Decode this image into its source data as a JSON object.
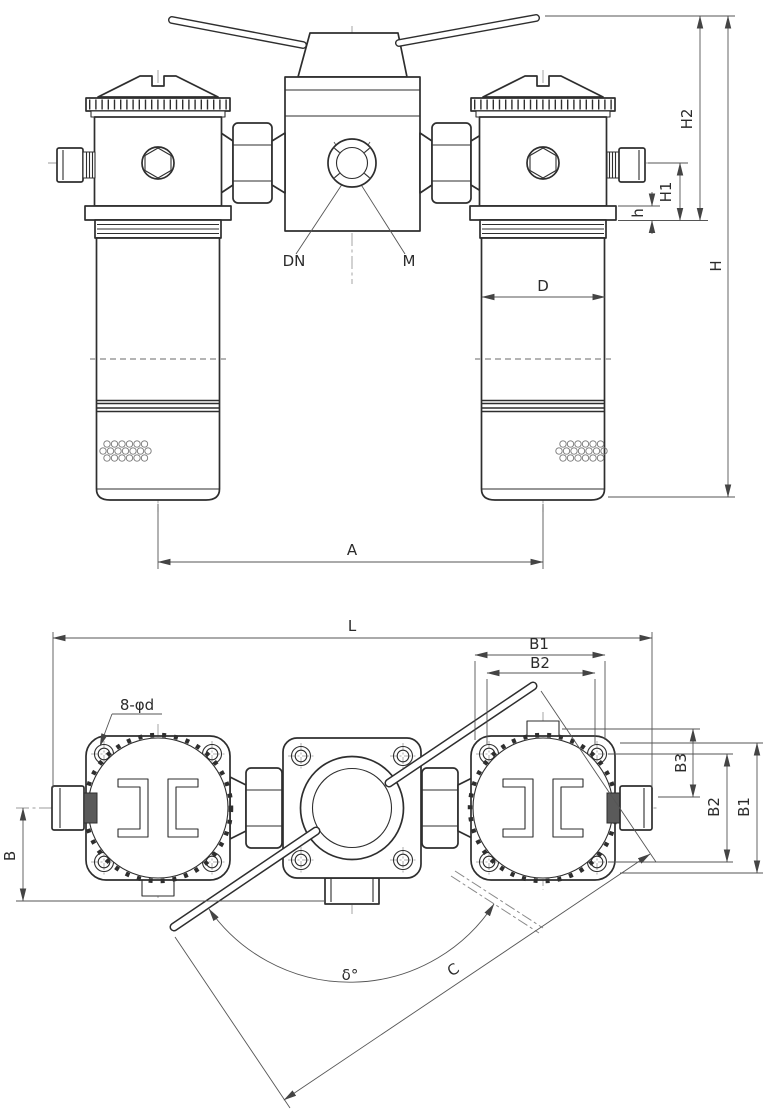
{
  "front_view": {
    "labels": {
      "dn": "DN",
      "m": "M",
      "d": "D",
      "a": "A",
      "h": "h",
      "h1": "H1",
      "h2": "H2",
      "h_total": "H"
    }
  },
  "bottom_view": {
    "labels": {
      "l": "L",
      "b1_top": "B1",
      "b2_top": "B2",
      "bolt_note": "8-φd",
      "b3": "B3",
      "b2_right": "B2",
      "b1_right": "B1",
      "b": "B",
      "delta": "δ°",
      "c": "C"
    }
  },
  "colors": {
    "outline": "#2e2e2e",
    "dimension": "#555555",
    "centerline": "#9b9b9b",
    "hidden_line": "#aaaaaa",
    "background": "#ffffff"
  }
}
